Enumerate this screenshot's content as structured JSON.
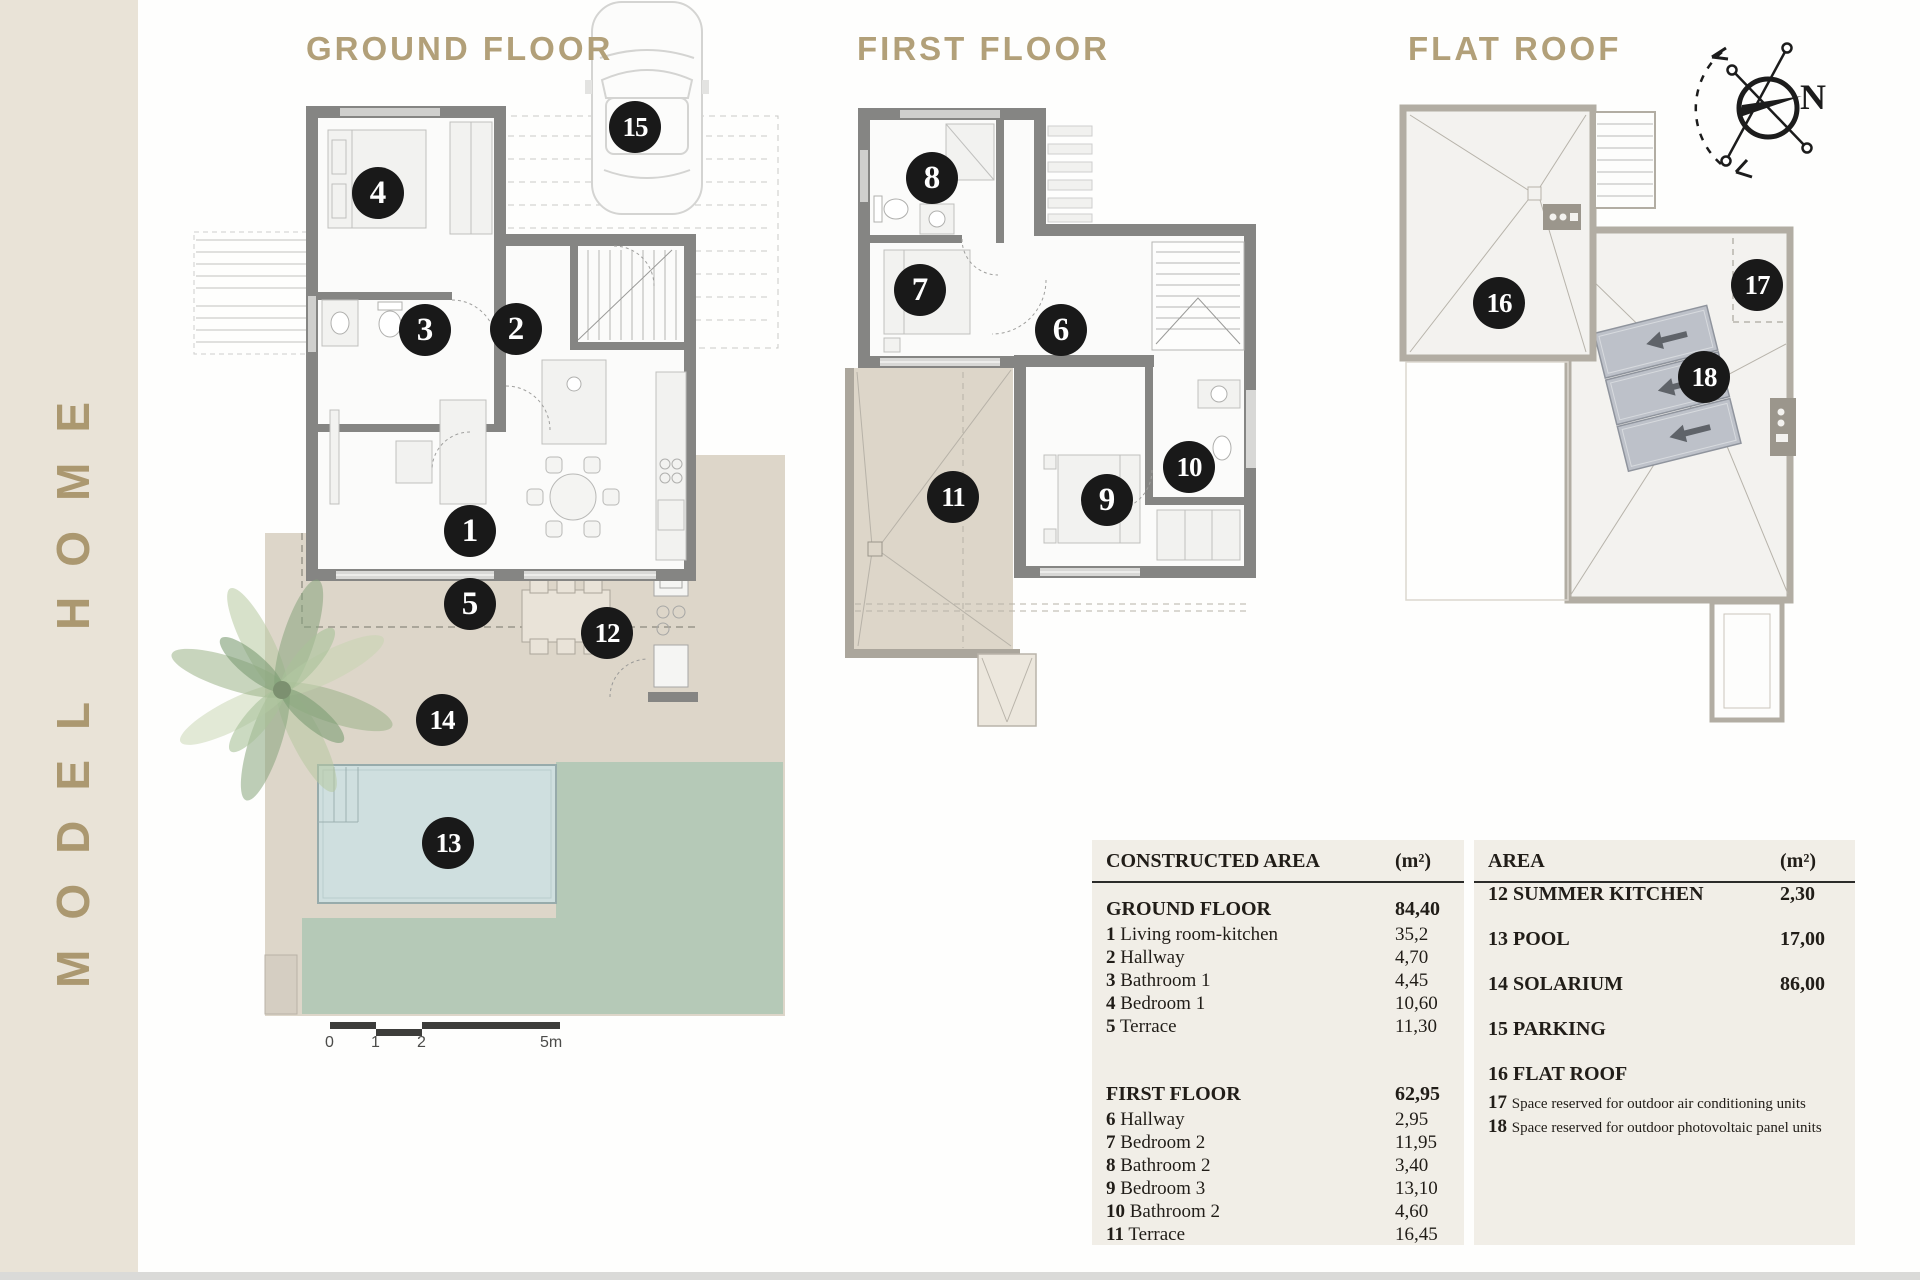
{
  "brand": {
    "vertical_text": "MODEL HOME"
  },
  "plans": {
    "ground": {
      "title": "GROUND FLOOR",
      "markers": [
        "1",
        "2",
        "3",
        "4",
        "5",
        "12",
        "13",
        "14",
        "15"
      ]
    },
    "first": {
      "title": "FIRST FLOOR",
      "markers": [
        "6",
        "7",
        "8",
        "9",
        "10",
        "11"
      ]
    },
    "roof": {
      "title": "FLAT ROOF",
      "markers": [
        "16",
        "17",
        "18"
      ]
    }
  },
  "compass": {
    "north": "N"
  },
  "scale": {
    "labels": [
      "0",
      "1",
      "2",
      "5m"
    ]
  },
  "colors": {
    "accent_gold": "#b2a079",
    "sidebar": "#e9e3d7",
    "marker": "#191919",
    "solarium": "#ddd6c9",
    "pool": "#cfdfdf",
    "lawn": "#b5c9b7",
    "wall": "#858583"
  },
  "tables": {
    "constructed": {
      "title": "CONSTRUCTED AREA",
      "unit": "(m²)",
      "sections": [
        {
          "name": "GROUND FLOOR",
          "total": "84,40",
          "rows": [
            {
              "n": "1",
              "label": "Living room-kitchen",
              "value": "35,2"
            },
            {
              "n": "2",
              "label": "Hallway",
              "value": "4,70"
            },
            {
              "n": "3",
              "label": "Bathroom 1",
              "value": "4,45"
            },
            {
              "n": "4",
              "label": "Bedroom 1",
              "value": "10,60"
            },
            {
              "n": "5",
              "label": "Terrace",
              "value": "11,30"
            }
          ]
        },
        {
          "name": "FIRST FLOOR",
          "total": "62,95",
          "rows": [
            {
              "n": "6",
              "label": "Hallway",
              "value": "2,95"
            },
            {
              "n": "7",
              "label": "Bedroom 2",
              "value": "11,95"
            },
            {
              "n": "8",
              "label": "Bathroom 2",
              "value": "3,40"
            },
            {
              "n": "9",
              "label": "Bedroom 3",
              "value": "13,10"
            },
            {
              "n": "10",
              "label": "Bathroom 2",
              "value": "4,60"
            },
            {
              "n": "11",
              "label": "Terrace",
              "value": "16,45"
            }
          ]
        }
      ]
    },
    "area": {
      "title": "AREA",
      "unit": "(m²)",
      "rows": [
        {
          "n": "12",
          "label": "SUMMER KITCHEN",
          "value": "2,30",
          "style": "caps"
        },
        {
          "n": "13",
          "label": "POOL",
          "value": "17,00",
          "style": "caps"
        },
        {
          "n": "14",
          "label": "SOLARIUM",
          "value": "86,00",
          "style": "caps"
        },
        {
          "n": "15",
          "label": "PARKING",
          "value": "",
          "style": "caps"
        },
        {
          "n": "16",
          "label": "FLAT ROOF",
          "value": "",
          "style": "caps"
        },
        {
          "n": "17",
          "label": "Space reserved for outdoor air conditioning units",
          "value": "",
          "style": "note"
        },
        {
          "n": "18",
          "label": "Space reserved for outdoor photovoltaic panel units",
          "value": "",
          "style": "note"
        }
      ]
    }
  }
}
